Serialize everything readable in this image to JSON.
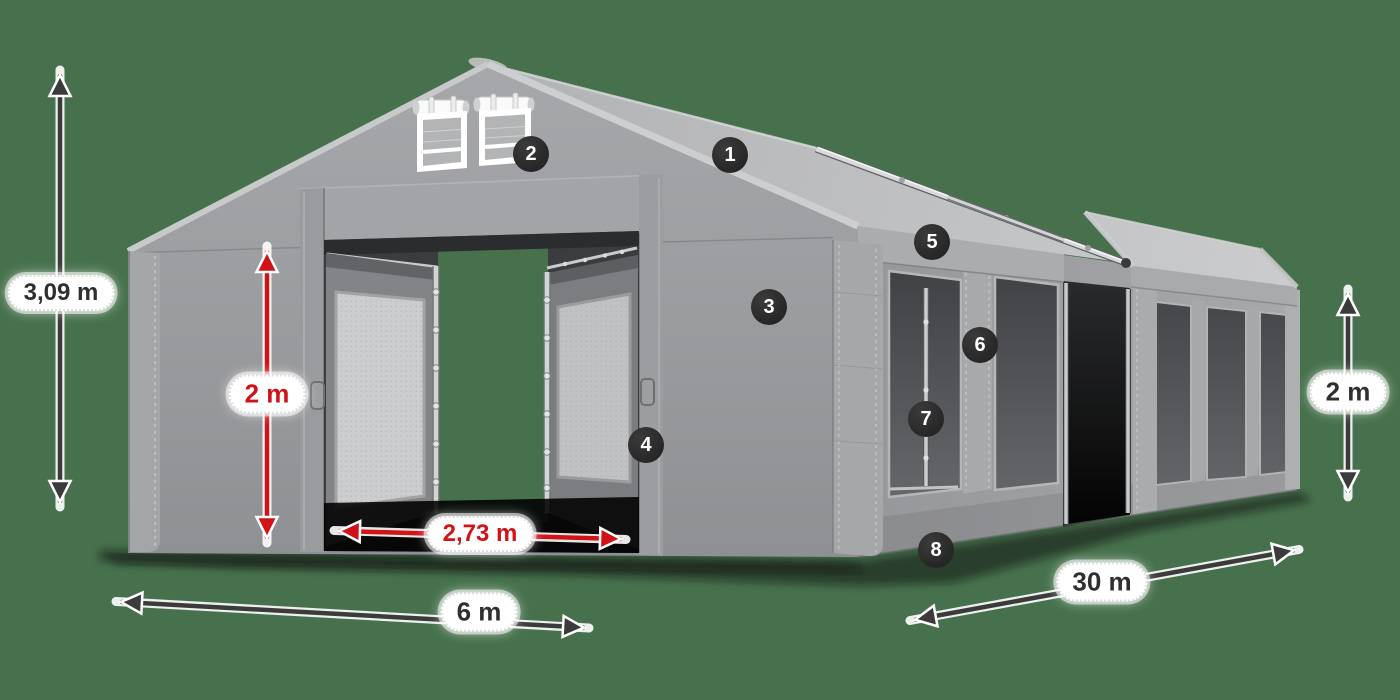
{
  "colors": {
    "background": "#47714D",
    "accent_red": "#D11318",
    "label_text_dark": "#2F2F2F",
    "marker_background": "#232324",
    "tent_gray": "#9B9C9F"
  },
  "markers": [
    {
      "number": "1"
    },
    {
      "number": "2"
    },
    {
      "number": "3"
    },
    {
      "number": "4"
    },
    {
      "number": "5"
    },
    {
      "number": "6"
    },
    {
      "number": "7"
    },
    {
      "number": "8"
    }
  ],
  "dimensions": {
    "total_height": {
      "label": "3,09 m",
      "style": "dark"
    },
    "left_side_height": {
      "label": "2 m",
      "style": "red"
    },
    "entrance_width": {
      "label": "2,73 m",
      "style": "red"
    },
    "front_width": {
      "label": "6 m",
      "style": "dark"
    },
    "side_length": {
      "label": "30 m",
      "style": "dark"
    },
    "right_side_height": {
      "label": "2 m",
      "style": "dark"
    }
  }
}
